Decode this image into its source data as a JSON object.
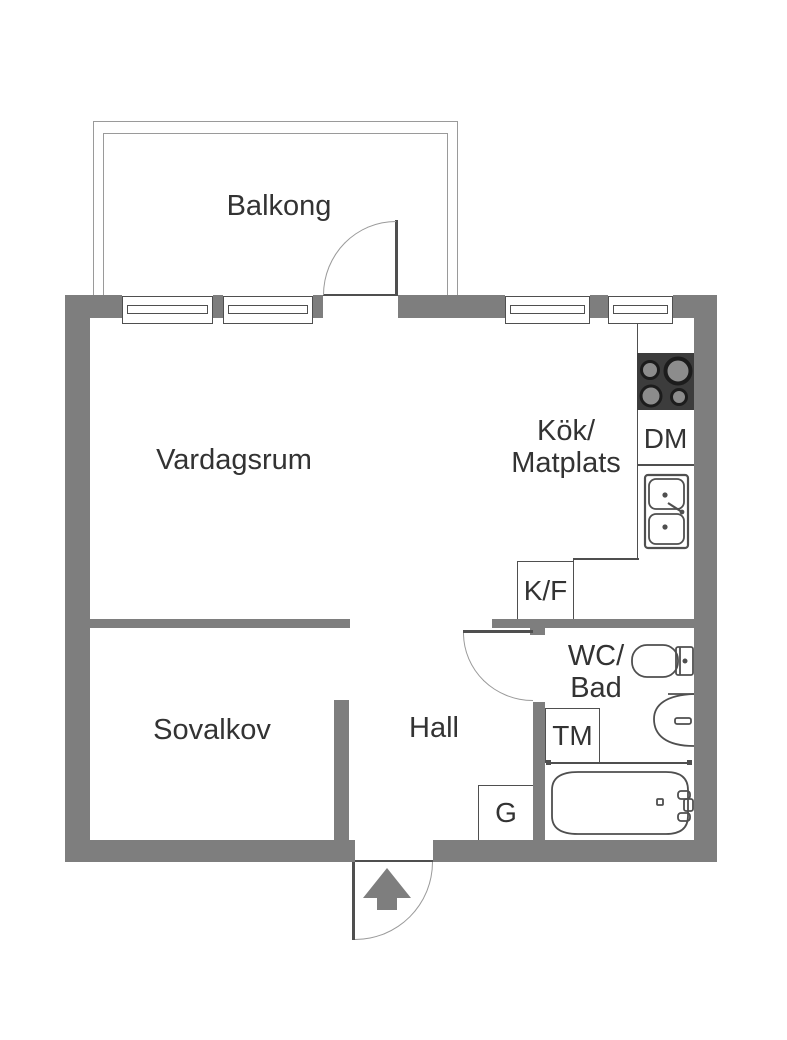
{
  "colors": {
    "background": "#ffffff",
    "wall": "#7e7e7e",
    "line": "#4f4f4f",
    "arc": "#9a9a9a",
    "text": "#333333",
    "stove": "#3c3c3c",
    "burner": "#8c8c8c",
    "burner_ring": "#1c1c1c"
  },
  "rooms": {
    "balcony": {
      "label": "Balkong"
    },
    "living_room": {
      "label": "Vardagsrum"
    },
    "kitchen": {
      "label_line1": "Kök/",
      "label_line2": "Matplats"
    },
    "sleeping_alcove": {
      "label": "Sovalkov"
    },
    "hall": {
      "label": "Hall"
    },
    "bathroom": {
      "label_line1": "WC/",
      "label_line2": "Bad"
    }
  },
  "appliances": {
    "dishwasher": "DM",
    "fridge_freezer": "K/F",
    "washing_machine": "TM",
    "wardrobe": "G"
  },
  "fixture_icons": [
    "stove-icon",
    "sink-icon",
    "toilet-icon",
    "washbasin-icon",
    "bathtub-icon",
    "shower-rail-icon",
    "entry-arrow-icon",
    "window-icon",
    "door-swing-icon"
  ]
}
